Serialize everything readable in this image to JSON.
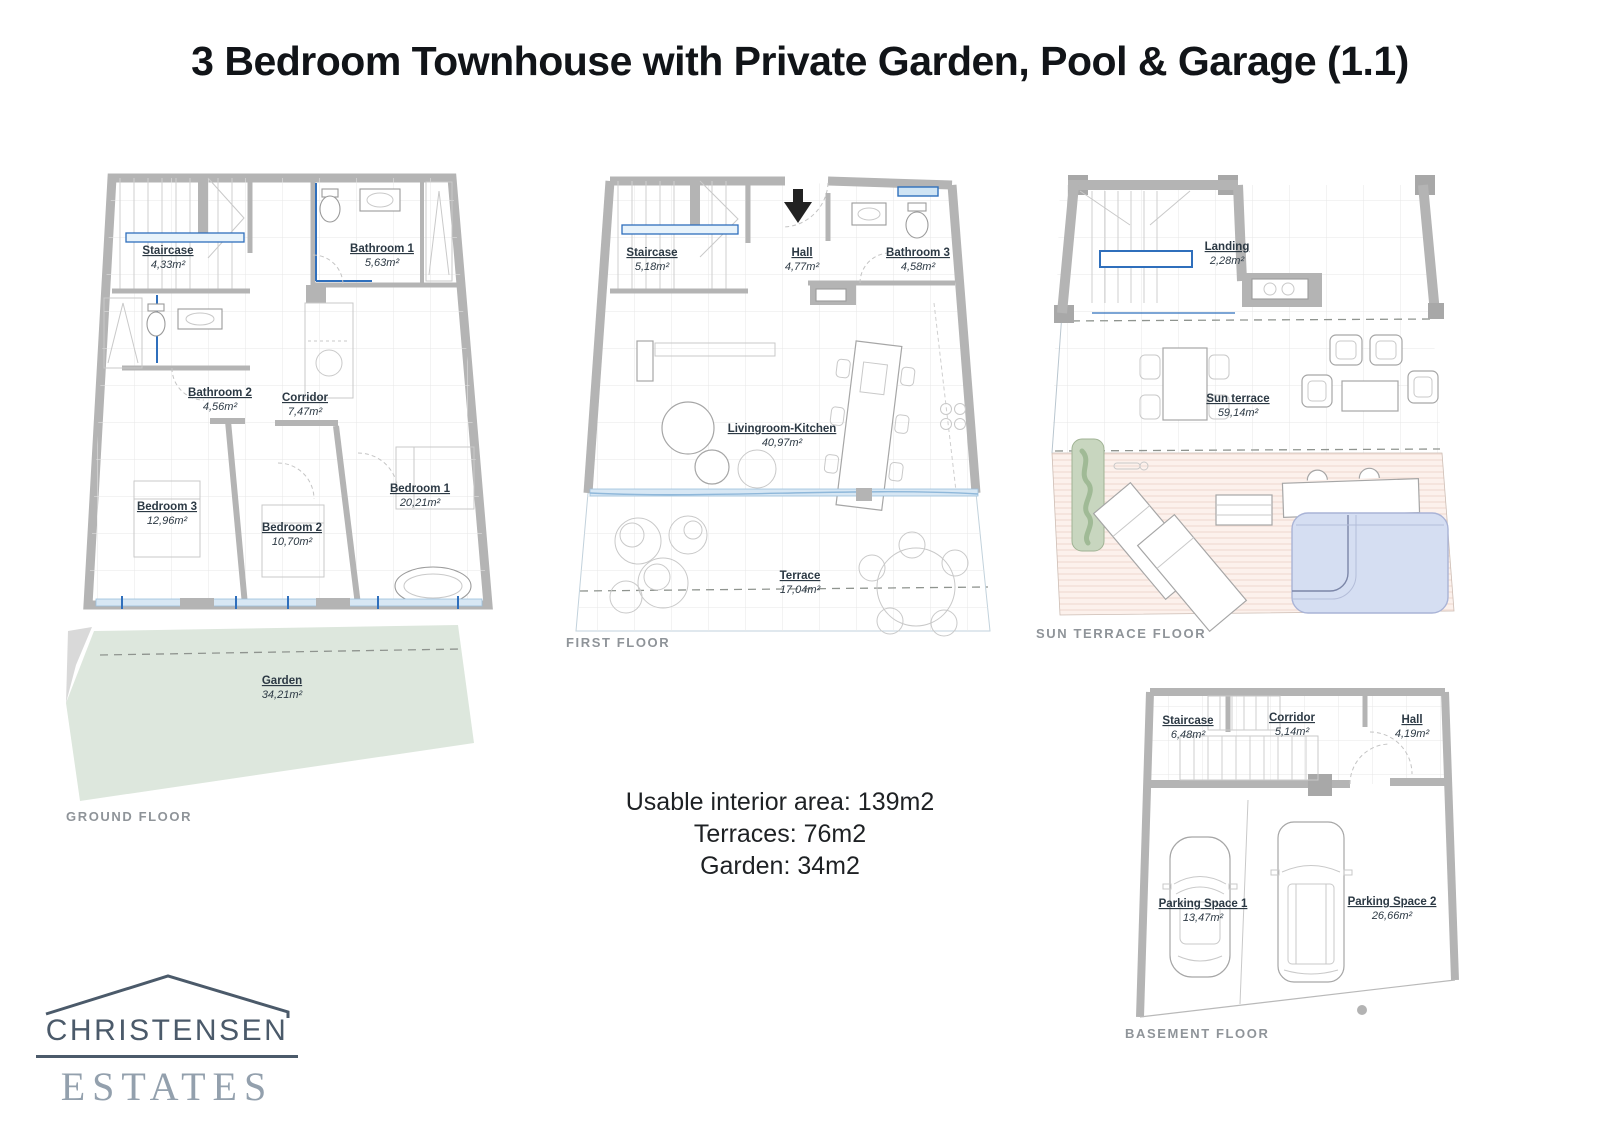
{
  "title": "3 Bedroom Townhouse with Private Garden, Pool & Garage (1.1)",
  "summary": {
    "interior": "Usable interior area: 139m2",
    "terraces": "Terraces: 76m2",
    "garden": "Garden: 34m2"
  },
  "logo": {
    "name": "CHRISTENSEN",
    "type": "ESTATES"
  },
  "colors": {
    "accent_blue": "#2f6fbc",
    "window_blue": "#d7e7f4",
    "garden_green": "#dde7dd",
    "pool_blue": "#d5def2",
    "deck_pink": "#fcf1ec",
    "wall_gray": "#b4b4b4",
    "logo_navy": "#4b5a6a",
    "logo_gray": "#93a0ad"
  },
  "floors": {
    "ground": {
      "caption": "GROUND FLOOR",
      "rooms": {
        "staircase": {
          "name": "Staircase",
          "area": "4,33m²"
        },
        "bathroom1": {
          "name": "Bathroom 1",
          "area": "5,63m²"
        },
        "bathroom2": {
          "name": "Bathroom 2",
          "area": "4,56m²"
        },
        "corridor": {
          "name": "Corridor",
          "area": "7,47m²"
        },
        "bedroom3": {
          "name": "Bedroom 3",
          "area": "12,96m²"
        },
        "bedroom2": {
          "name": "Bedroom 2",
          "area": "10,70m²"
        },
        "bedroom1": {
          "name": "Bedroom 1",
          "area": "20,21m²"
        },
        "garden": {
          "name": "Garden",
          "area": "34,21m²"
        }
      }
    },
    "first": {
      "caption": "FIRST FLOOR",
      "rooms": {
        "staircase": {
          "name": "Staircase",
          "area": "5,18m²"
        },
        "hall": {
          "name": "Hall",
          "area": "4,77m²"
        },
        "bathroom3": {
          "name": "Bathroom 3",
          "area": "4,58m²"
        },
        "living": {
          "name": "Livingroom-Kitchen",
          "area": "40,97m²"
        },
        "terrace": {
          "name": "Terrace",
          "area": "17,04m²"
        }
      }
    },
    "sun_terrace": {
      "caption": "SUN TERRACE FLOOR",
      "rooms": {
        "landing": {
          "name": "Landing",
          "area": "2,28m²"
        },
        "sunterrace": {
          "name": "Sun terrace",
          "area": "59,14m²"
        }
      }
    },
    "basement": {
      "caption": "BASEMENT FLOOR",
      "rooms": {
        "staircase": {
          "name": "Staircase",
          "area": "6,48m²"
        },
        "corridor": {
          "name": "Corridor",
          "area": "5,14m²"
        },
        "hall": {
          "name": "Hall",
          "area": "4,19m²"
        },
        "parking1": {
          "name": "Parking Space 1",
          "area": "13,47m²"
        },
        "parking2": {
          "name": "Parking Space 2",
          "area": "26,66m²"
        }
      }
    }
  }
}
